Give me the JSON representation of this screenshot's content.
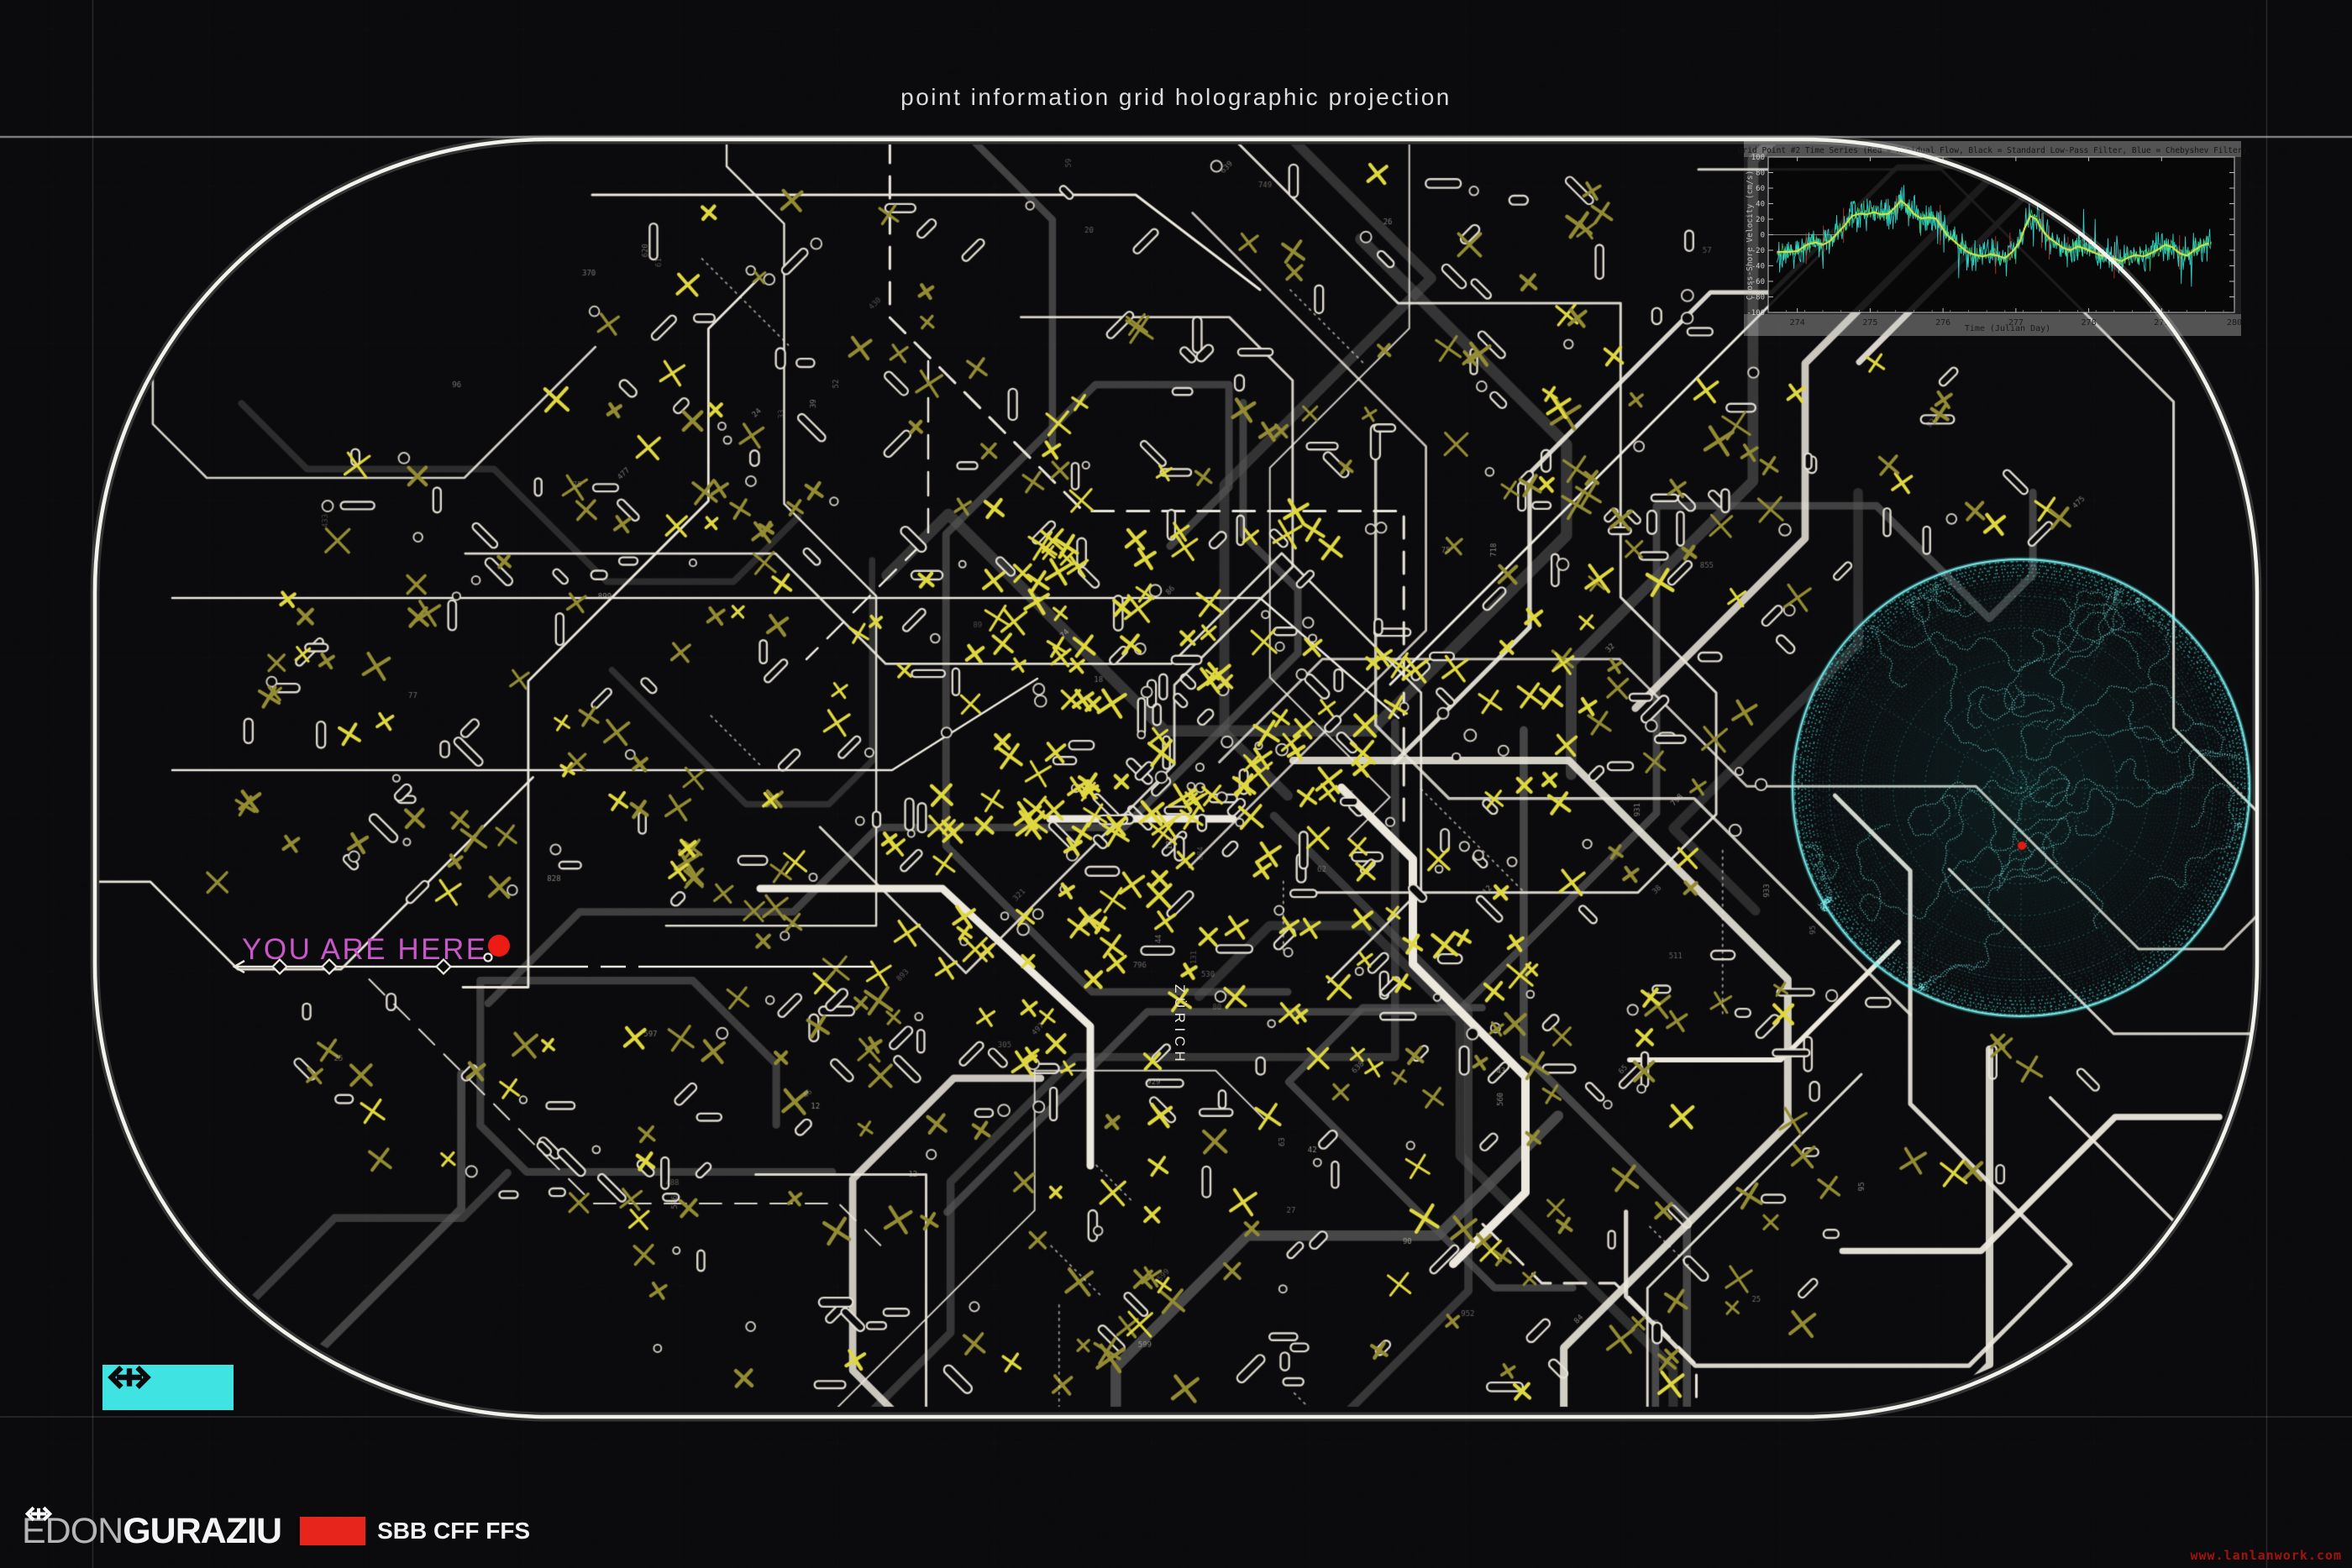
{
  "header": {
    "title": "point information grid holographic projection"
  },
  "you_are_here": {
    "label": "YOU ARE HERE"
  },
  "map": {
    "city_label": "ZÜRICH",
    "seed": 23,
    "x_marks": 560,
    "stations": 340,
    "circles": 140,
    "routes_white": 26,
    "routes_gray": 20,
    "tiny_labels": 85,
    "dotted_lines": 14,
    "feature_routes": [
      {
        "w": 2.5,
        "pts": [
          [
            205,
            712
          ],
          [
            1500,
            712
          ],
          [
            1665,
            855
          ]
        ]
      },
      {
        "w": 2.5,
        "pts": [
          [
            205,
            917
          ],
          [
            1062,
            917
          ],
          [
            1235,
            808
          ]
        ]
      },
      {
        "w": 9,
        "pts": [
          [
            1250,
            975
          ],
          [
            1468,
            975
          ]
        ]
      },
      {
        "w": 10,
        "pts": [
          [
            1597,
            938
          ],
          [
            1682,
            1023
          ],
          [
            1682,
            1148
          ],
          [
            1816,
            1282
          ],
          [
            1816,
            1420
          ],
          [
            1730,
            1505
          ]
        ]
      },
      {
        "w": 3,
        "pts": [
          [
            2215,
            255
          ],
          [
            1655,
            815
          ]
        ]
      },
      {
        "w": 9,
        "pts": [
          [
            905,
            1058
          ],
          [
            1122,
            1058
          ],
          [
            1298,
            1222
          ],
          [
            1298,
            1388
          ]
        ]
      },
      {
        "w": 3,
        "pts": [
          [
            705,
            232
          ],
          [
            1352,
            232
          ],
          [
            1500,
            345
          ]
        ]
      },
      {
        "w": 6,
        "pts": [
          [
            1940,
            1262
          ],
          [
            2120,
            1262
          ],
          [
            2260,
            1122
          ]
        ]
      },
      {
        "w": 2.5,
        "pts": [
          [
            1105,
            430
          ],
          [
            1105,
            640
          ],
          [
            960,
            785
          ]
        ],
        "dash": [
          28,
          16
        ]
      }
    ]
  },
  "globe": {
    "seed": 9,
    "rings": 7,
    "meridians": 12,
    "marker_color": "#e11a12"
  },
  "chart_data": {
    "type": "line",
    "title": "Grid Point #2 Time Series (Red = Residual Flow, Black = Standard Low-Pass Filter, Blue = Chebyshev Filter)",
    "xlabel": "Time (Julian Day)",
    "ylabel": "Cross-Shore Velocity (cm/s)",
    "xlim": [
      273.6,
      280
    ],
    "ylim": [
      -100,
      100
    ],
    "xticks": [
      274,
      275,
      276,
      277,
      278,
      279,
      280
    ],
    "yticks": [
      -100,
      -80,
      -60,
      -40,
      -20,
      0,
      20,
      40,
      60,
      80,
      100
    ],
    "grid": false,
    "series": [
      {
        "name": "Residual Flow",
        "display_color": "#2fd8cf",
        "style": "noisy"
      },
      {
        "name": "Standard Low-Pass Filter",
        "display_color": "#d3e44c",
        "style": "smooth",
        "x": [
          273.72,
          273.9,
          274.0,
          274.05,
          274.15,
          274.25,
          274.35,
          274.45,
          274.55,
          274.65,
          274.75,
          274.85,
          274.95,
          275.05,
          275.15,
          275.25,
          275.35,
          275.42,
          275.5,
          275.6,
          275.7,
          275.8,
          275.9,
          275.97,
          276.05,
          276.15,
          276.25,
          276.35,
          276.45,
          276.55,
          276.65,
          276.75,
          276.85,
          276.95,
          277.05,
          277.12,
          277.2,
          277.28,
          277.35,
          277.45,
          277.55,
          277.65,
          277.75,
          277.85,
          277.95,
          278.05,
          278.15,
          278.25,
          278.35,
          278.45,
          278.55,
          278.65,
          278.75,
          278.85,
          278.95,
          279.05,
          279.15,
          279.25,
          279.35,
          279.45,
          279.55,
          279.65
        ],
        "y": [
          -22,
          -22,
          -21,
          -18,
          -12,
          -10,
          -13,
          -8,
          2,
          12,
          24,
          27,
          26,
          29,
          26,
          27,
          36,
          44,
          38,
          27,
          21,
          22,
          21,
          12,
          0,
          -8,
          -16,
          -23,
          -26,
          -28,
          -25,
          -27,
          -30,
          -22,
          -10,
          8,
          24,
          20,
          8,
          -4,
          -10,
          -17,
          -20,
          -15,
          -18,
          -22,
          -26,
          -28,
          -31,
          -34,
          -29,
          -26,
          -28,
          -24,
          -19,
          -13,
          -16,
          -24,
          -27,
          -20,
          -14,
          -11
        ]
      },
      {
        "name": "Chebyshev Filter",
        "display_color": "#46e27f",
        "style": "smooth-overlay"
      }
    ],
    "zero_reference_line": {
      "x_end": 274.55,
      "y": 0
    }
  },
  "footer": {
    "author_light": "EDON",
    "author_bold": "GURAZIU",
    "brand": "SBB CFF FFS"
  },
  "watermark": {
    "text": "www.lanlanwork.com"
  },
  "colors": {
    "background": "#0b0a0c",
    "frame_white": "#f4f2ec",
    "map_white": "#ece8dd",
    "map_gray": "#565656",
    "x_bright": "#e0d83f",
    "x_dim": "#938c33",
    "accent_cyan": "#3fe3e2",
    "accent_magenta": "#c857c8",
    "accent_red": "#ea1c15",
    "brand_red": "#e8251c"
  }
}
